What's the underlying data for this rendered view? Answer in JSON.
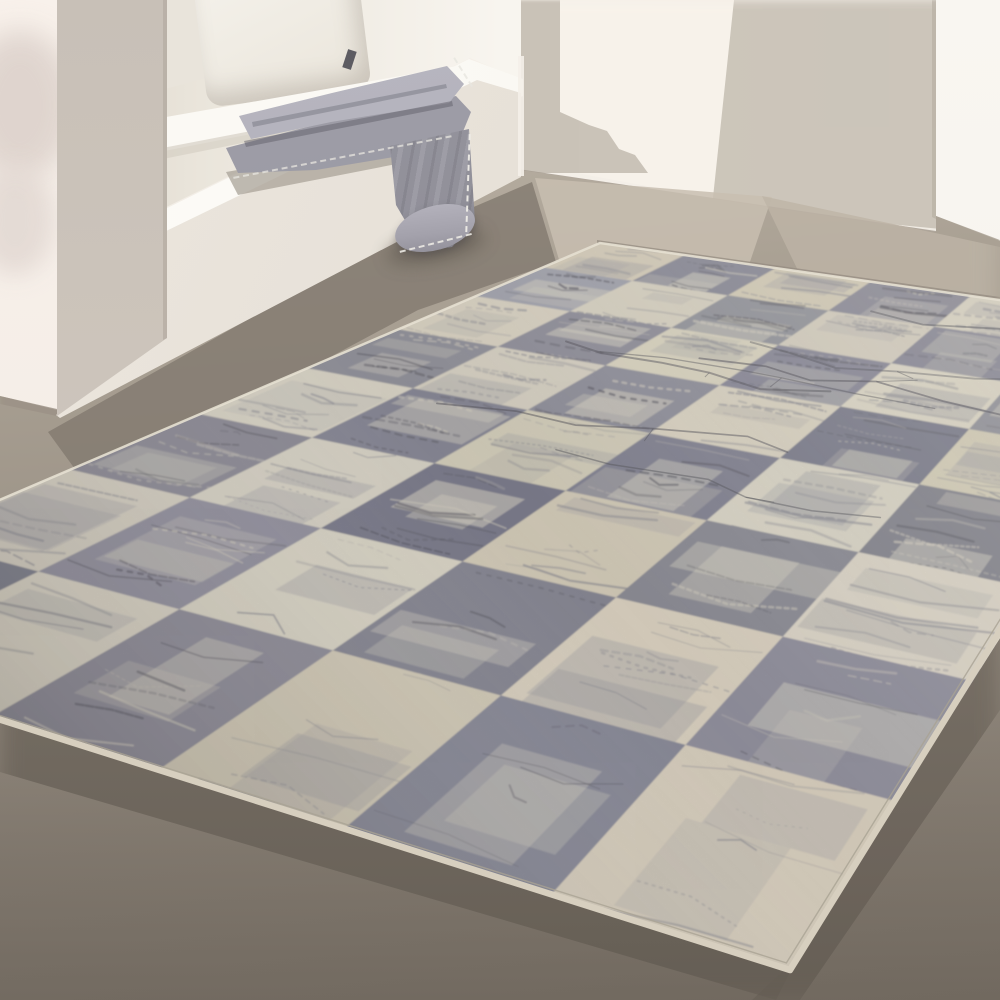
{
  "scene": {
    "type": "interior-product-photo",
    "subject": "Distressed gray and cream checkered area rug on a concrete floor, beside a white built-in bench nook with a cushion, pillows and a folded gray fringed blanket, sunlight casting soft shadows on the walls",
    "palette": {
      "wall_base": "#f3eee7",
      "wall_left_bright": "#f8f1eb",
      "wall_left_shadow": "#ddd2cc",
      "wall_shadow": "#c7c0b5",
      "wall_corner_strip": "#cac3b8",
      "wall_right_bright": "#f9f6f1",
      "wall_seam": "#a0978b",
      "pillar_top": "#c8c0b7",
      "pillar_bottom": "#e0d9cf",
      "bench_face": "#ece6de",
      "bench_face_dark": "#d8d1c7",
      "seat_top": "#fdfcf8",
      "niche_bright": "#f8f5ef",
      "niche_shadow": "#d8d1c6",
      "pillow": "#f4f1ea",
      "pillow_tag": "#5d5c62",
      "blanket_light": "#b9b8c2",
      "blanket_mid": "#95949e",
      "blanket_dark": "#7f7e88",
      "stitch": "#efede7",
      "floor_light": "#beb5a8",
      "floor_mid": "#a49b8f",
      "floor_dark": "#8e857a",
      "floor_deep": "#746c62",
      "rug_cream": "#ded8c9",
      "rug_gray": "#9a99a0",
      "rug_streak_dark": "#5a5962",
      "rug_marl_light": "#d6d0c3",
      "rug_binding": "#d7cfbf",
      "rug_seam": "#a9a294",
      "rug_edge_highlight": "#e6e0d1"
    },
    "rug": {
      "corners": {
        "top": [
          600,
          243
        ],
        "right": [
          1188,
          327
        ],
        "bottom": [
          790,
          970
        ],
        "left": [
          -295,
          626
        ]
      },
      "grid": {
        "cols": 6,
        "rows": 8,
        "seed": 9,
        "pattern": "checkerboard",
        "start_color": "cream"
      },
      "distress": {
        "streaks_per_cell_min": 4,
        "streaks_per_cell_max": 9,
        "twig_scratches": 7
      }
    }
  }
}
